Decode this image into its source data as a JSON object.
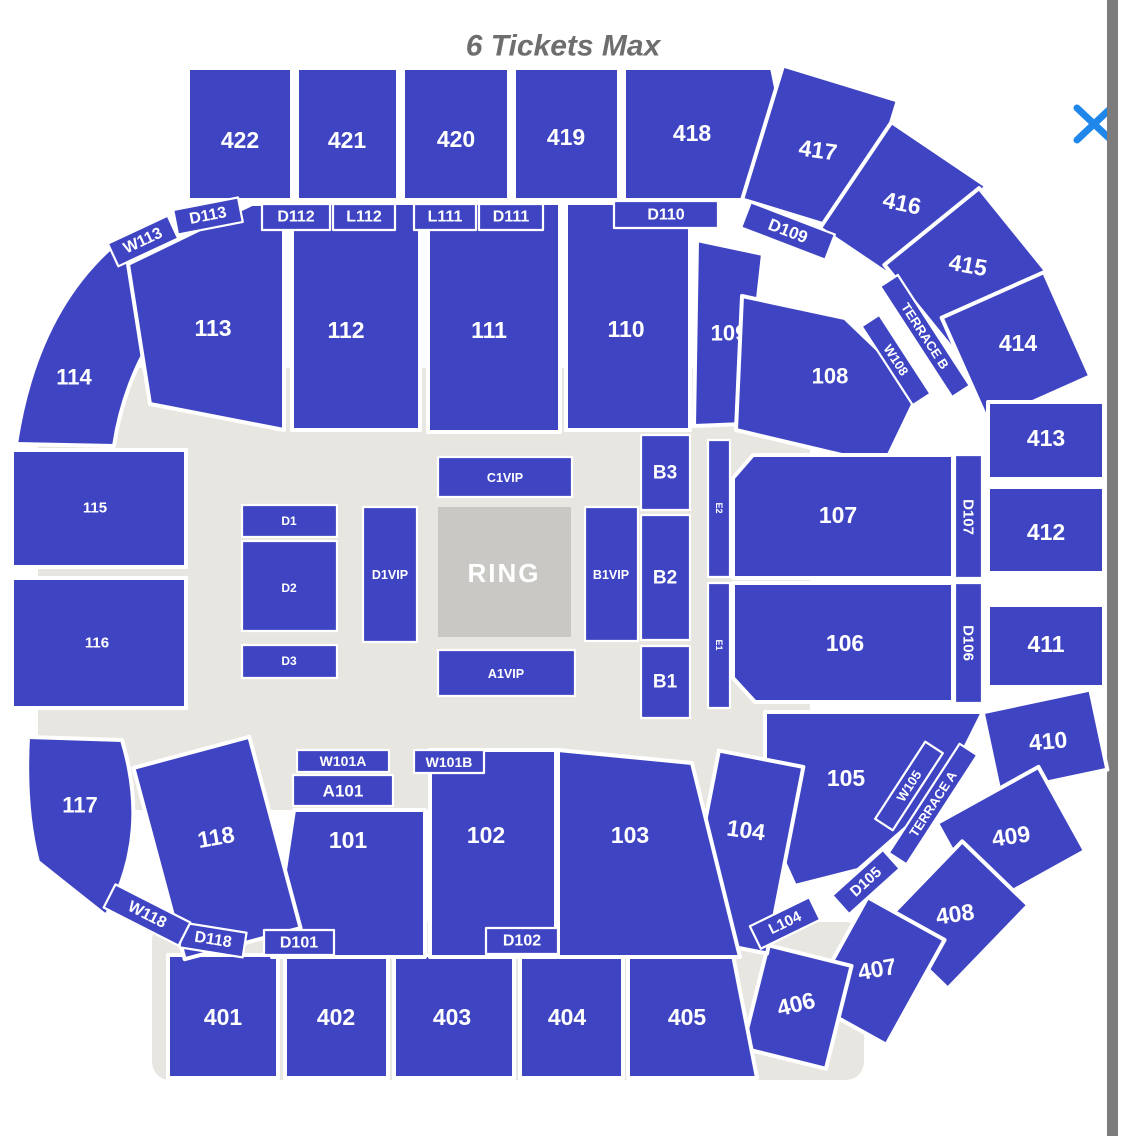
{
  "header": {
    "title": "6 Tickets Max"
  },
  "colors": {
    "section_blue": "#3f45c2",
    "floor_gray": "#e8e6e1",
    "ring_gray": "#c9c8c4",
    "close_blue": "#1f87ea",
    "scrollbar_gray": "#7c7c7c",
    "title_gray": "#6e6e6e"
  },
  "labels": {
    "s401": "401",
    "s402": "402",
    "s403": "403",
    "s404": "404",
    "s405": "405",
    "s406": "406",
    "s407": "407",
    "s408": "408",
    "s409": "409",
    "s410": "410",
    "s411": "411",
    "s412": "412",
    "s413": "413",
    "s414": "414",
    "s415": "415",
    "s416": "416",
    "s417": "417",
    "s418": "418",
    "s419": "419",
    "s420": "420",
    "s421": "421",
    "s422": "422",
    "s101": "101",
    "s102": "102",
    "s103": "103",
    "s104": "104",
    "s105": "105",
    "s106": "106",
    "s107": "107",
    "s108": "108",
    "s109": "109",
    "s110": "110",
    "s111": "111",
    "s112": "112",
    "s113": "113",
    "s114": "114",
    "s115": "115",
    "s116": "116",
    "s117": "117",
    "s118": "118",
    "w113": "W113",
    "d113": "D113",
    "d112": "D112",
    "l112": "L112",
    "l111": "L111",
    "d111": "D111",
    "d110": "D110",
    "d109": "D109",
    "terrace_b": "TERRACE B",
    "w108": "W108",
    "d107": "D107",
    "d106": "D106",
    "w105": "W105",
    "terrace_a": "TERRACE A",
    "d105": "D105",
    "l104": "L104",
    "d102": "D102",
    "d101": "D101",
    "d118": "D118",
    "w118": "W118",
    "w101a": "W101A",
    "a101": "A101",
    "w101b": "W101B",
    "c1vip": "C1VIP",
    "a1vip": "A1VIP",
    "d1vip": "D1VIP",
    "b1vip": "B1VIP",
    "ring": "RING",
    "d1": "D1",
    "d2": "D2",
    "d3": "D3",
    "b1": "B1",
    "b2": "B2",
    "b3": "B3",
    "e1": "E1",
    "e2": "E2"
  }
}
